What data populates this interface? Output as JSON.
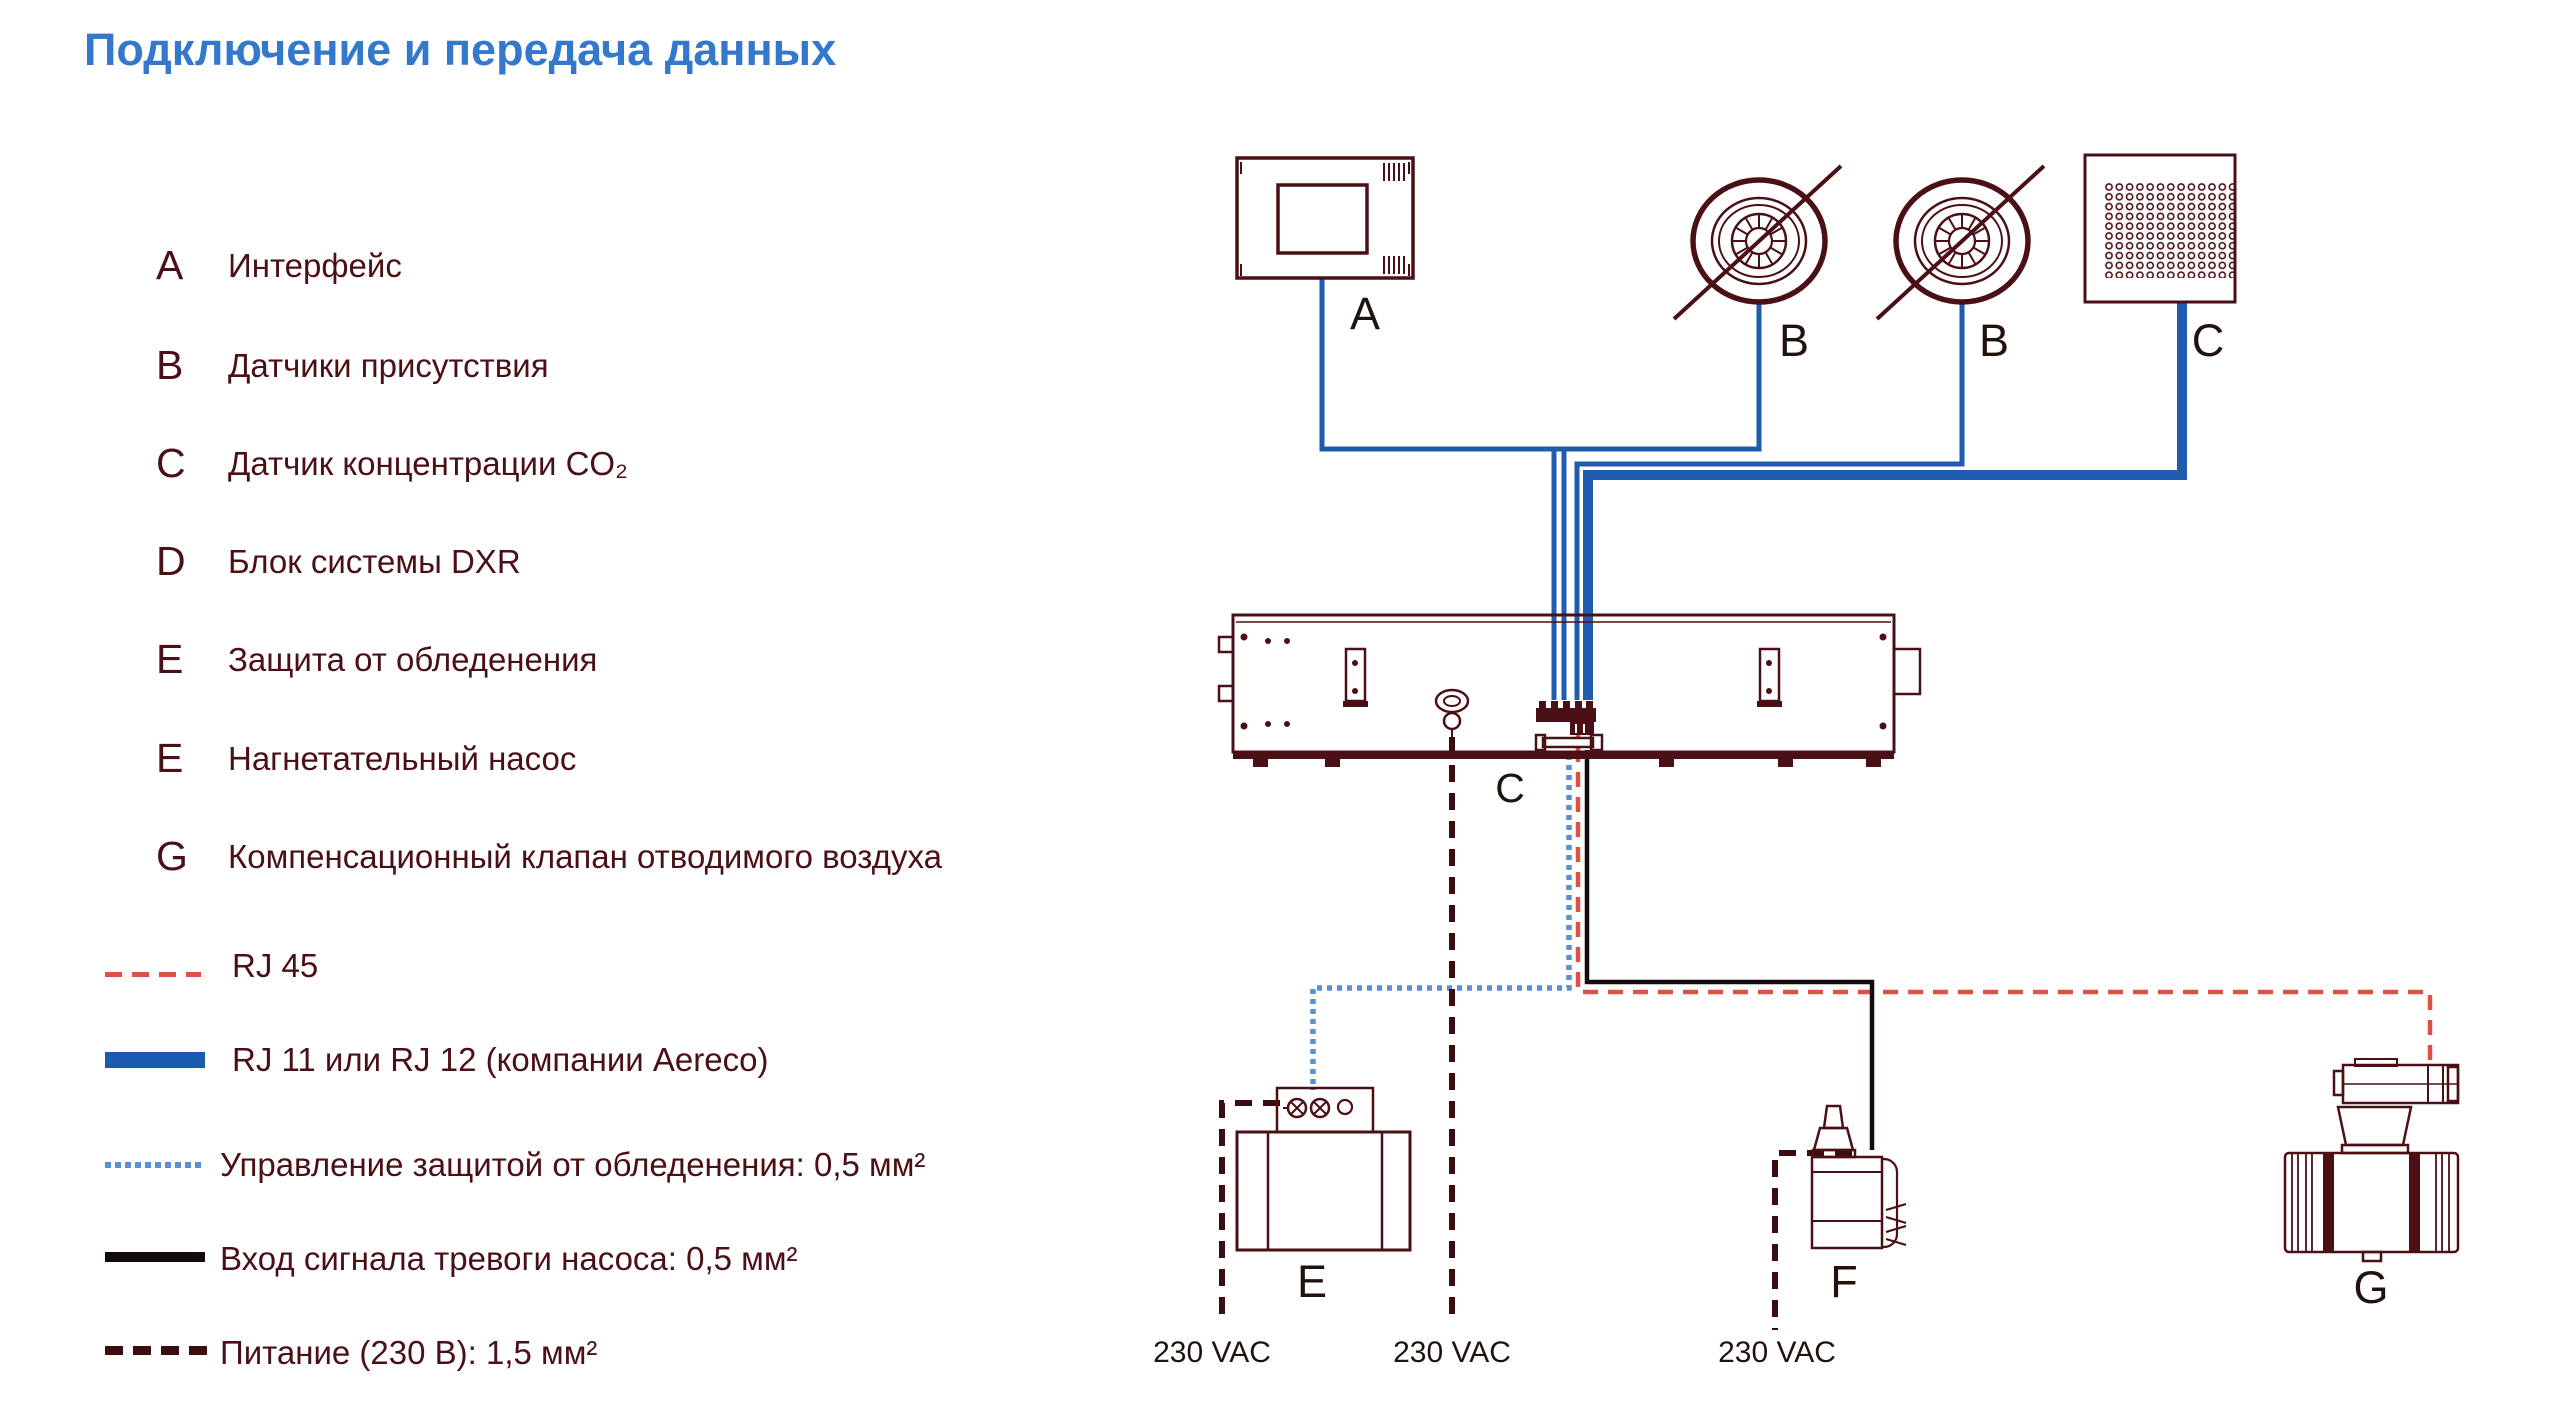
{
  "title": "Подключение и передача данных",
  "legend": {
    "items": [
      {
        "letter": "A",
        "text": "Интерфейс"
      },
      {
        "letter": "B",
        "text": "Датчики присутствия"
      },
      {
        "letter": "C",
        "text": "Датчик концентрации CO₂"
      },
      {
        "letter": "D",
        "text": "Блок системы DXR"
      },
      {
        "letter": "E",
        "text": "Защита от обледенения"
      },
      {
        "letter": "E",
        "text": "Нагнетательный насос"
      },
      {
        "letter": "G",
        "text": "Компенсационный клапан отводимого воздуха"
      }
    ]
  },
  "line_legend": {
    "items": [
      {
        "id": "rj45",
        "text": "RJ 45"
      },
      {
        "id": "rj11",
        "text": "RJ 11 или RJ 12 (компании Aereco)"
      },
      {
        "id": "frost-control",
        "text": "Управление защитой от обледенения: 0,5 мм²"
      },
      {
        "id": "pump-alarm",
        "text": "Вход сигнала тревоги насоса: 0,5 мм²"
      },
      {
        "id": "power",
        "text": "Питание (230 В): 1,5 мм²"
      }
    ]
  },
  "diagram": {
    "labels": {
      "interface": "A",
      "presence1": "B",
      "presence2": "B",
      "co2": "C",
      "unit": "C",
      "frost": "E",
      "pump": "F",
      "valve": "G"
    },
    "power_label": "230 VAC"
  },
  "colors": {
    "title": "#3478CC",
    "legend_text": "#4A1015",
    "outline": "#4A1015",
    "device_label": "#20130E",
    "rj45": "#DC5247",
    "rj11": "#1A5BAD",
    "frost": "#5C8FD2",
    "alarm": "#140C0C",
    "power": "#3C0D10",
    "wire": "#1F5CAF"
  }
}
